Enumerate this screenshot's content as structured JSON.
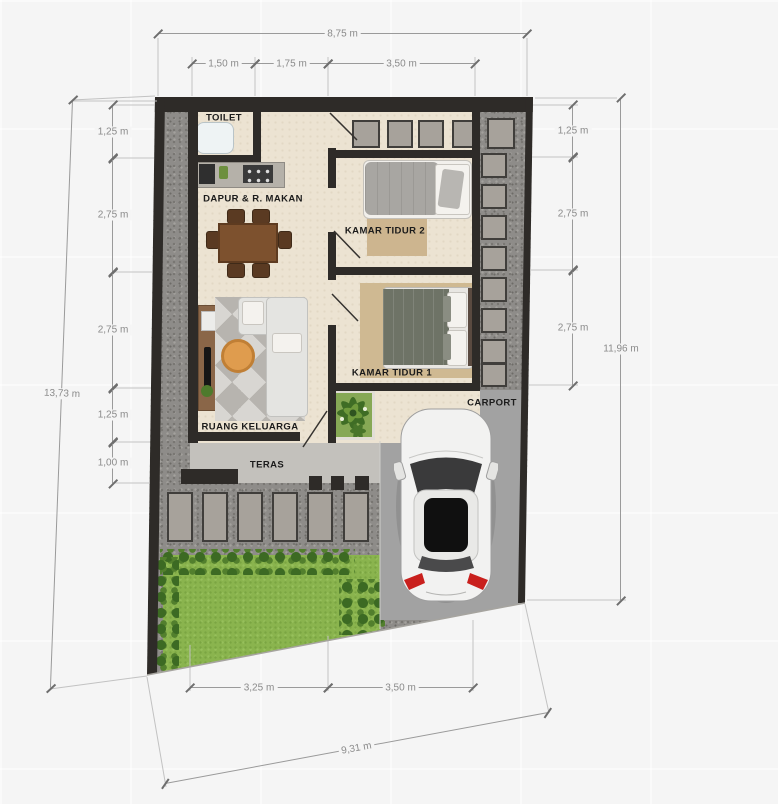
{
  "plan": {
    "rooms": {
      "toilet": "TOILET",
      "kitchen_dining": "DAPUR & R. MAKAN",
      "bedroom2": "KAMAR TIDUR 2",
      "bedroom1": "KAMAR TIDUR 1",
      "family_room": "RUANG KELUARGA",
      "terrace": "TERAS",
      "carport": "CARPORT"
    },
    "dimensions": {
      "top": {
        "total": "8,75 m",
        "segments": [
          "1,50 m",
          "1,75 m",
          "3,50 m"
        ]
      },
      "left": {
        "total": "13,73 m",
        "segments": [
          "1,25 m",
          "2,75 m",
          "2,75 m",
          "1,25 m",
          "1,00 m"
        ]
      },
      "right": {
        "total": "11,96 m",
        "segments": [
          "1,25 m",
          "2,75 m",
          "2,75 m"
        ]
      },
      "bottom": {
        "total": "9,31 m",
        "segments": [
          "3,25 m",
          "3,50 m"
        ]
      }
    },
    "colors": {
      "background": "#f5f5f5",
      "wall": "#2e2b28",
      "gravel": "#8e8c89",
      "floor": "#ece3d2",
      "grass": "#8ab44e",
      "hedge": "#3c6a23",
      "carport": "#a2a2a2",
      "terrace": "#c3c1bc",
      "dimension_text": "#8a8a8a",
      "label_text": "#1b1b1b",
      "car_body": "#f2f2f1",
      "taillight": "#c9201d",
      "table_wood": "#7d512e",
      "coffee_table": "#df9c4e"
    }
  }
}
